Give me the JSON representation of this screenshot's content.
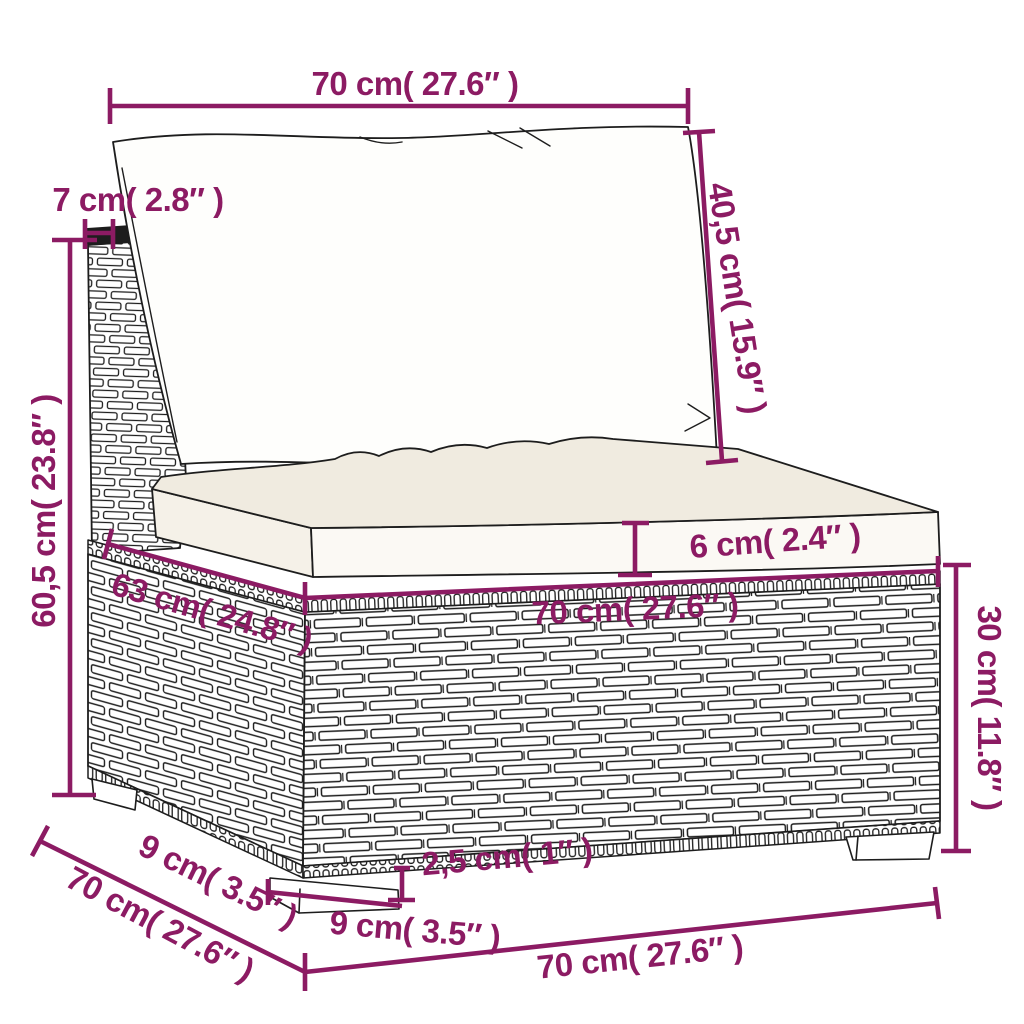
{
  "diagram": {
    "subject": "rattan-sofa-section-dimension-drawing",
    "colors": {
      "dimension_accent": "#8c1b63",
      "line_art": "#1d1d1d",
      "seat_cushion_top": "#f0ebe0",
      "background": "#ffffff"
    },
    "dimensions": {
      "back_cushion_width": {
        "label": "70 cm( 27.6″  )"
      },
      "back_panel_thickness": {
        "label": "7 cm( 2.8″  )"
      },
      "back_cushion_height": {
        "label": "40,5 cm( 15.9″  )"
      },
      "total_height": {
        "label": "60,5 cm( 23.8″  )"
      },
      "seat_cushion_thickness": {
        "label": "6 cm( 2.4″  )"
      },
      "seat_width": {
        "label": "70 cm( 27.6″  )"
      },
      "seat_depth": {
        "label": "63 cm( 24.8″  )"
      },
      "base_height": {
        "label": "30 cm( 11.8″  )"
      },
      "overall_depth": {
        "label": "70 cm( 27.6″  )"
      },
      "leg_depth": {
        "label": "9 cm( 3.5″  )"
      },
      "leg_width": {
        "label": "9 cm( 3.5″  )"
      },
      "leg_height": {
        "label": "2,5 cm( 1″  )"
      },
      "overall_width": {
        "label": "70 cm( 27.6″  )"
      }
    }
  }
}
